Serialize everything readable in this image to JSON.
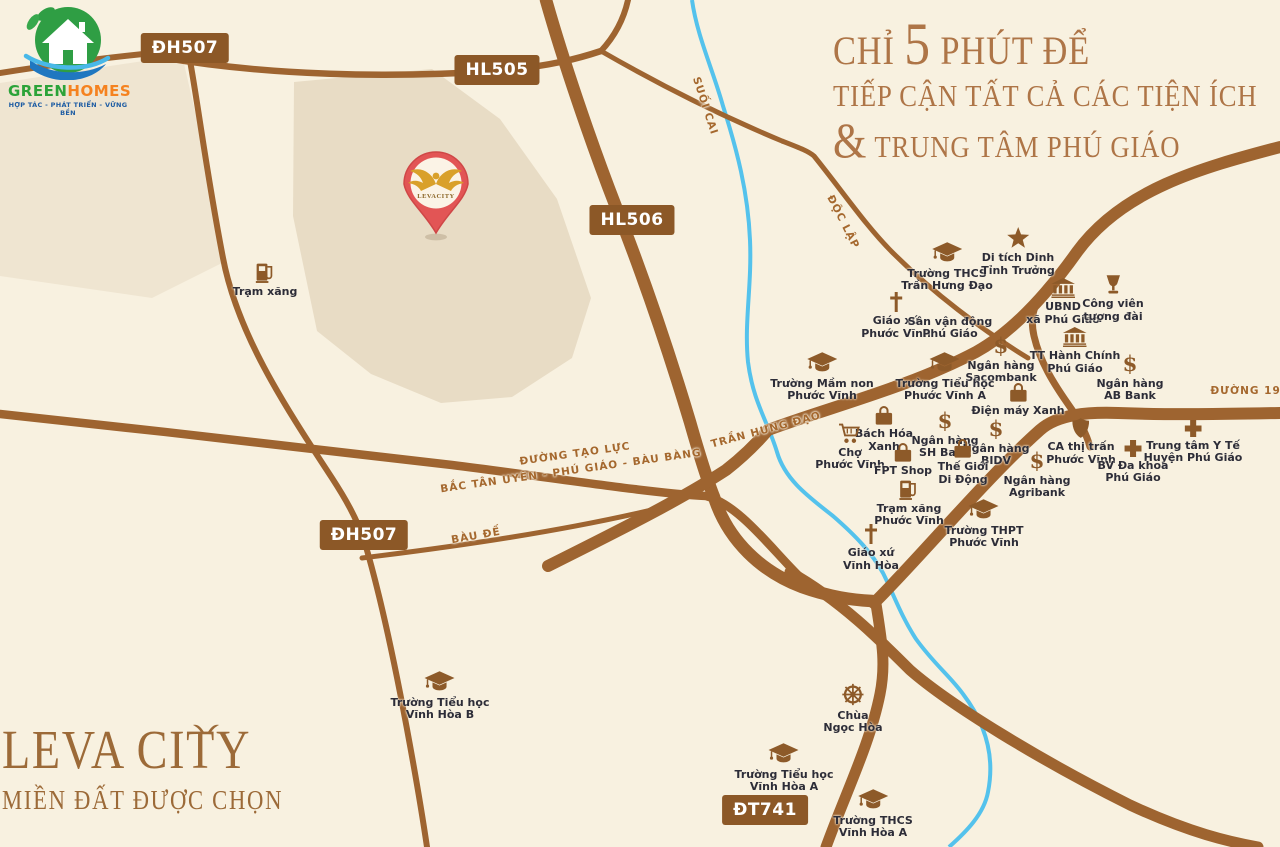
{
  "brand": {
    "name_green": "GREEN",
    "name_orange": "HOMES",
    "tagline": "HỢP TÁC - PHÁT TRIỂN - VỮNG BỀN"
  },
  "headline": {
    "line1_pre": "CHỈ",
    "line1_number": "5",
    "line1_post": "PHÚT ĐỂ",
    "line2": "TIẾP CẬN TẤT CẢ CÁC TIỆN ÍCH",
    "line3_amp": "&",
    "line3": "TRUNG TÂM PHÚ GIÁO"
  },
  "project": {
    "name": "LEVA CITY",
    "tagline": "MIỀN ĐẤT ĐƯỢC CHỌN",
    "pin_label": "LEVACITY"
  },
  "road_labels": [
    {
      "text": "ĐH507",
      "x": 185,
      "y": 48
    },
    {
      "text": "HL505",
      "x": 497,
      "y": 70
    },
    {
      "text": "HL506",
      "x": 632,
      "y": 220
    },
    {
      "text": "ĐH507",
      "x": 364,
      "y": 535
    },
    {
      "text": "ĐT741",
      "x": 765,
      "y": 810
    }
  ],
  "street_names": [
    {
      "text": "SUỐI CAI",
      "x": 705,
      "y": 106,
      "angle": 72
    },
    {
      "text": "ĐỘC LẬP",
      "x": 843,
      "y": 222,
      "angle": 63
    },
    {
      "text": "TRẦN HƯNG ĐẠO",
      "x": 766,
      "y": 430,
      "angle": -15
    },
    {
      "text": "ĐƯỜNG TẠO LỰC",
      "x": 575,
      "y": 454,
      "angle": -8
    },
    {
      "text": "BẮC TÂN UYÊN - PHÚ GIÁO - BÀU BÀNG",
      "x": 571,
      "y": 471,
      "angle": -8
    },
    {
      "text": "BÀU ĐẾ",
      "x": 476,
      "y": 536,
      "angle": -10
    },
    {
      "text": "ĐƯỜNG 19 T",
      "x": 1252,
      "y": 391,
      "angle": 0
    }
  ],
  "pois": [
    {
      "icon": "gas",
      "x": 265,
      "y": 272,
      "lines": [
        "Trạm xăng"
      ]
    },
    {
      "icon": "grad",
      "x": 947,
      "y": 253,
      "lines": [
        "Trường THCS",
        "Trần Hưng Đạo"
      ]
    },
    {
      "icon": "star",
      "x": 1018,
      "y": 238,
      "lines": [
        "Di tích Dinh",
        "Tỉnh Trưởng"
      ]
    },
    {
      "icon": "church",
      "x": 896,
      "y": 302,
      "lines": [
        "Giáo xứ",
        "Phước Vĩnh"
      ]
    },
    {
      "icon": "stadium",
      "x": 950,
      "y": 302,
      "lines": [
        "Sân vận động",
        "Phú Giáo"
      ]
    },
    {
      "icon": "bank",
      "x": 1063,
      "y": 288,
      "lines": [
        "UBND",
        "xã Phú Giáo"
      ]
    },
    {
      "icon": "trophy",
      "x": 1113,
      "y": 285,
      "lines": [
        "Công viên",
        "tượng đài"
      ]
    },
    {
      "icon": "dollar",
      "x": 1001,
      "y": 345,
      "lines": [
        "Ngân hàng",
        "Sacombank"
      ]
    },
    {
      "icon": "bank",
      "x": 1075,
      "y": 337,
      "lines": [
        "TT Hành Chính",
        "Phú Giáo"
      ]
    },
    {
      "icon": "grad",
      "x": 822,
      "y": 363,
      "lines": [
        "Trường Mầm non",
        "Phước Vĩnh"
      ]
    },
    {
      "icon": "grad",
      "x": 945,
      "y": 363,
      "lines": [
        "Trường Tiểu học",
        "Phước Vĩnh A"
      ]
    },
    {
      "icon": "dollar",
      "x": 1130,
      "y": 363,
      "lines": [
        "Ngân hàng",
        "AB Bank"
      ]
    },
    {
      "icon": "bag",
      "x": 1018,
      "y": 392,
      "lines": [
        "Điện máy Xanh"
      ]
    },
    {
      "icon": "bag",
      "x": 884,
      "y": 415,
      "lines": [
        "Bách Hóa",
        "Xanh"
      ]
    },
    {
      "icon": "dollar",
      "x": 945,
      "y": 420,
      "lines": [
        "Ngân hàng",
        "SH Bank"
      ]
    },
    {
      "icon": "cart",
      "x": 850,
      "y": 433,
      "lines": [
        "Chợ",
        "Phước Vĩnh"
      ]
    },
    {
      "icon": "dollar",
      "x": 996,
      "y": 428,
      "lines": [
        "Ngân hàng",
        "BIDV"
      ]
    },
    {
      "icon": "shield",
      "x": 1081,
      "y": 428,
      "lines": [
        "CA thị trấn",
        "Phước Vĩnh"
      ]
    },
    {
      "icon": "medcross",
      "x": 1193,
      "y": 428,
      "lines": [
        "Trung tâm Y Tế",
        "Huyện Phú Giáo"
      ]
    },
    {
      "icon": "bag",
      "x": 903,
      "y": 452,
      "lines": [
        "FPT Shop"
      ]
    },
    {
      "icon": "bag",
      "x": 963,
      "y": 448,
      "lines": [
        "Thế Giới",
        "Di Động"
      ]
    },
    {
      "icon": "dollar",
      "x": 1037,
      "y": 460,
      "lines": [
        "Ngân hàng",
        "Agribank"
      ]
    },
    {
      "icon": "medcross",
      "x": 1133,
      "y": 448,
      "lines": [
        "BV Đa khoa",
        "Phú Giáo"
      ]
    },
    {
      "icon": "gas",
      "x": 909,
      "y": 489,
      "lines": [
        "Trạm xăng",
        "Phước Vĩnh"
      ]
    },
    {
      "icon": "grad",
      "x": 984,
      "y": 510,
      "lines": [
        "Trường THPT",
        "Phước Vĩnh"
      ]
    },
    {
      "icon": "church",
      "x": 871,
      "y": 534,
      "lines": [
        "Giáo xứ",
        "Vĩnh Hòa"
      ]
    },
    {
      "icon": "grad",
      "x": 440,
      "y": 682,
      "lines": [
        "Trường Tiểu học",
        "Vĩnh Hòa B"
      ]
    },
    {
      "icon": "wheel",
      "x": 853,
      "y": 694,
      "lines": [
        "Chùa",
        "Ngọc Hòa"
      ]
    },
    {
      "icon": "grad",
      "x": 784,
      "y": 754,
      "lines": [
        "Trường Tiểu học",
        "Vĩnh Hòa A"
      ]
    },
    {
      "icon": "grad",
      "x": 873,
      "y": 800,
      "lines": [
        "Trường THCS",
        "Vĩnh Hòa A"
      ]
    }
  ],
  "colors": {
    "background": "#f8f1e0",
    "land_parcel": "#e8dcc5",
    "road": "#9e6430",
    "road_label_bg": "#8c5827",
    "river": "#54c2ec",
    "poi_icon": "#8d5a29",
    "poi_text": "#2d2d38",
    "street_text": "#a5682e",
    "headline_text": "#ae7547",
    "project_text": "#9c6a38",
    "pin_red": "#e25555",
    "logo_green": "#2ca339",
    "logo_orange": "#f5821f",
    "logo_blue": "#1d5ca3"
  }
}
